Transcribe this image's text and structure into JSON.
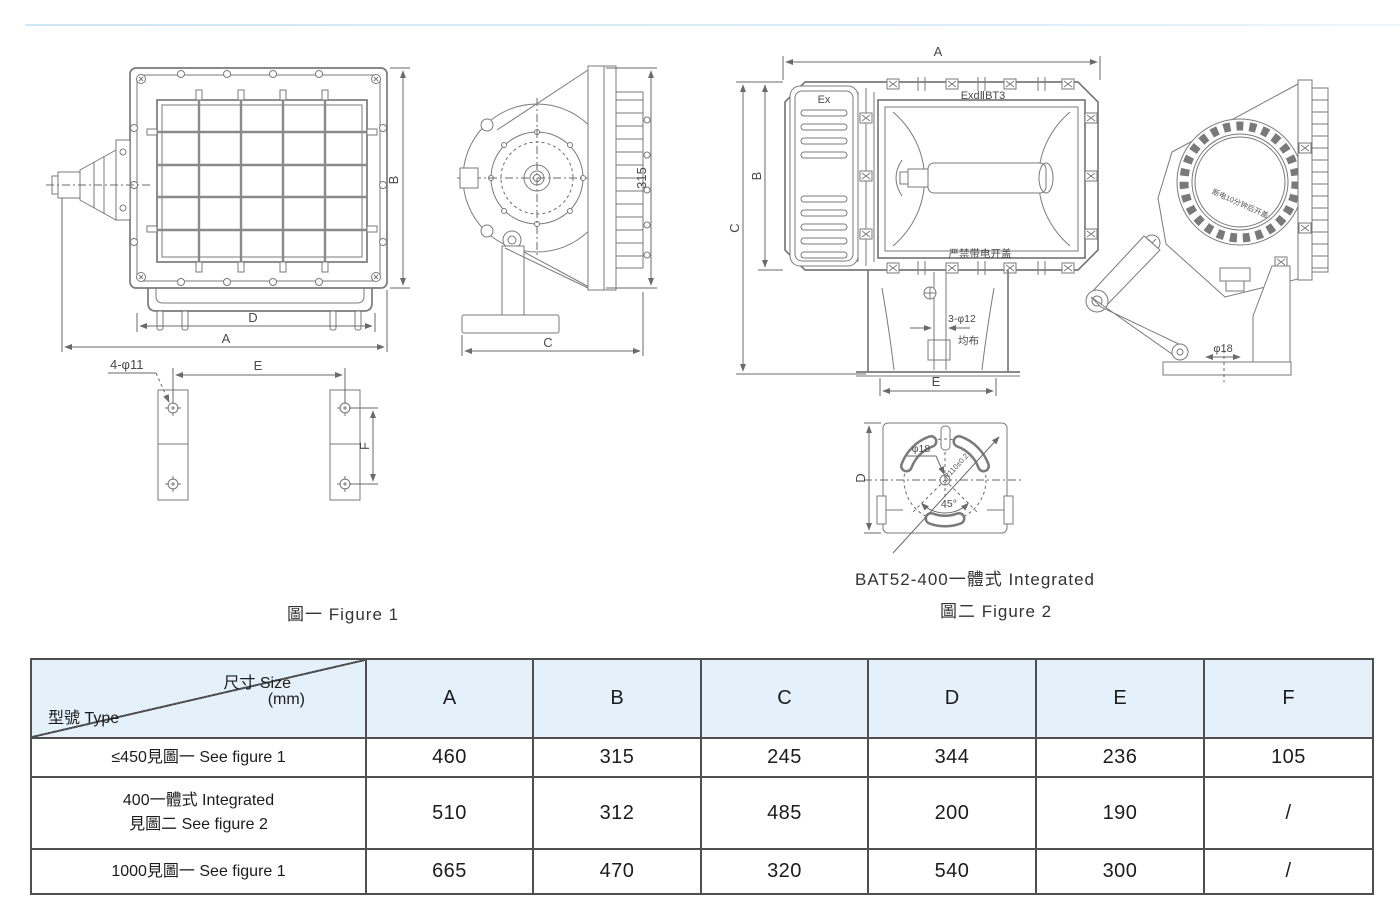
{
  "captions": {
    "figure1": "圖一 Figure 1",
    "figure2_title": "BAT52-400一體式 Integrated",
    "figure2": "圖二 Figure 2"
  },
  "figure1": {
    "front": {
      "dim_a": "A",
      "dim_b": "B",
      "dim_d": "D"
    },
    "side": {
      "dim_c": "C",
      "dim_height": "315"
    },
    "bracket": {
      "holes_label": "4-φ11",
      "dim_e": "E",
      "dim_f": "F"
    }
  },
  "figure2": {
    "front": {
      "dim_a": "A",
      "dim_b": "B",
      "dim_c": "C",
      "dim_e": "E",
      "ex_mark": "Ex",
      "rating_mark": "ExdⅡBT3",
      "warning": "严禁带电开盖",
      "holes_label": "3-φ12",
      "holes_note": "均布"
    },
    "side": {
      "ring_note": "断电10分钟后开盖",
      "dim_phi18": "φ18"
    },
    "base": {
      "dim_d": "D",
      "dim_phi18": "φ18",
      "angle": "45°",
      "radius_note": "R110±0.2"
    }
  },
  "table": {
    "header": {
      "size_label": "尺寸 Size",
      "size_unit": "(mm)",
      "type_label": "型號 Type",
      "columns": [
        "A",
        "B",
        "C",
        "D",
        "E",
        "F"
      ]
    },
    "rows": [
      {
        "type_line1": "≤450見圖一 See figure 1",
        "type_line2": "",
        "values": [
          "460",
          "315",
          "245",
          "344",
          "236",
          "105"
        ]
      },
      {
        "type_line1": "400一體式 Integrated",
        "type_line2": "見圖二 See figure 2",
        "values": [
          "510",
          "312",
          "485",
          "200",
          "190",
          "/"
        ]
      },
      {
        "type_line1": "1000見圖一 See figure 1",
        "type_line2": "",
        "values": [
          "665",
          "470",
          "320",
          "540",
          "300",
          "/"
        ]
      }
    ]
  }
}
